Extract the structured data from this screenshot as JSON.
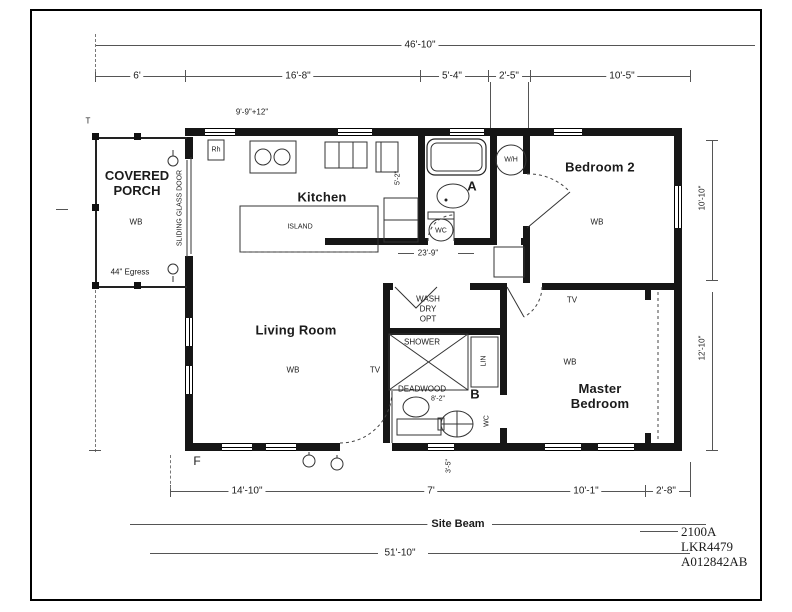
{
  "title_block": {
    "model": "2100A",
    "serial": "LKR4479",
    "drawing_number": "A012842AB"
  },
  "rooms": {
    "covered_porch": "COVERED PORCH",
    "kitchen": "Kitchen",
    "living_room": "Living Room",
    "bedroom_2": "Bedroom 2",
    "master_bedroom": "Master Bedroom",
    "bath_a": "A",
    "bath_b": "B"
  },
  "fixtures": {
    "island": "ISLAND",
    "wash": "WASH",
    "dry": "DRY",
    "opt": "OPT",
    "shower": "SHOWER",
    "deadwood": "DEADWOOD",
    "water_heater": "W/H",
    "toilet": "WC",
    "linen": "LIN",
    "range_hood": "Rh"
  },
  "markers": {
    "wall_board": "WB",
    "tv": "TV",
    "egress": "44\" Egress",
    "sliding_door": "SLIDING GLASS DOOR",
    "site_beam": "Site Beam",
    "tag_t": "T",
    "tag_f": "F"
  },
  "dimensions": {
    "top_overall": "46'-10\"",
    "top_row": [
      "6'",
      "16'-8\"",
      "5'-4\"",
      "2'-5\"",
      "10'-5\""
    ],
    "kitchen_wall": "9'-9\"+12\"",
    "hall_width": "23'-9\"",
    "pantry_depth": "5'-2\"",
    "bath_b_width": "8'-2\"",
    "door_offset": "3'-5\"",
    "right_upper": "10'-10\"",
    "right_lower": "12'-10\"",
    "bottom_row": [
      "14'-10\"",
      "7'",
      "10'-1\"",
      "2'-8\""
    ],
    "bottom_overall": "51'-10\""
  }
}
